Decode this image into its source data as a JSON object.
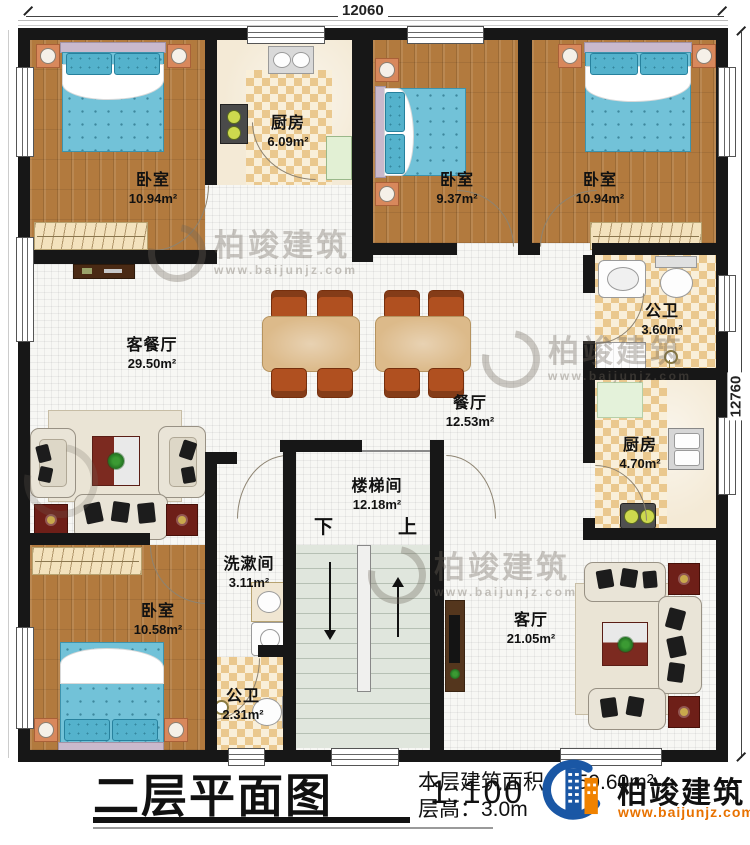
{
  "plan": {
    "dimensions": {
      "top": "12060",
      "right": "12760"
    },
    "rooms": [
      {
        "id": "bedroom_top_left",
        "name": "卧室",
        "area": "10.94m²"
      },
      {
        "id": "kitchen_top",
        "name": "厨房",
        "area": "6.09m²"
      },
      {
        "id": "bedroom_top_mid",
        "name": "卧室",
        "area": "9.37m²"
      },
      {
        "id": "bedroom_top_right",
        "name": "卧室",
        "area": "10.94m²"
      },
      {
        "id": "living_dining",
        "name": "客餐厅",
        "area": "29.50m²"
      },
      {
        "id": "dining",
        "name": "餐厅",
        "area": "12.53m²"
      },
      {
        "id": "bath_upper",
        "name": "公卫",
        "area": "3.60m²"
      },
      {
        "id": "kitchen_right",
        "name": "厨房",
        "area": "4.70m²"
      },
      {
        "id": "stairwell",
        "name": "楼梯间",
        "area": "12.18m²"
      },
      {
        "id": "washroom",
        "name": "洗漱间",
        "area": "3.11m²"
      },
      {
        "id": "bath_lower",
        "name": "公卫",
        "area": "2.31m²"
      },
      {
        "id": "bedroom_bot_left",
        "name": "卧室",
        "area": "10.58m²"
      },
      {
        "id": "living_room",
        "name": "客厅",
        "area": "21.05m²"
      }
    ],
    "stairs": {
      "down": "下",
      "up": "上"
    }
  },
  "title_block": {
    "title": "二层平面图",
    "scale": "1:100",
    "area_label": "本层建筑面积：",
    "area_value": "159.60m²",
    "floor_height_label": "层高：",
    "floor_height_value": "3.0m"
  },
  "brand": {
    "name": "柏竣建筑",
    "website": "www.baijunjz.com",
    "blue": "#1a57a5",
    "orange": "#f08200"
  },
  "watermark": {
    "text": "柏竣建筑",
    "url": "www.baijunjz.com"
  }
}
